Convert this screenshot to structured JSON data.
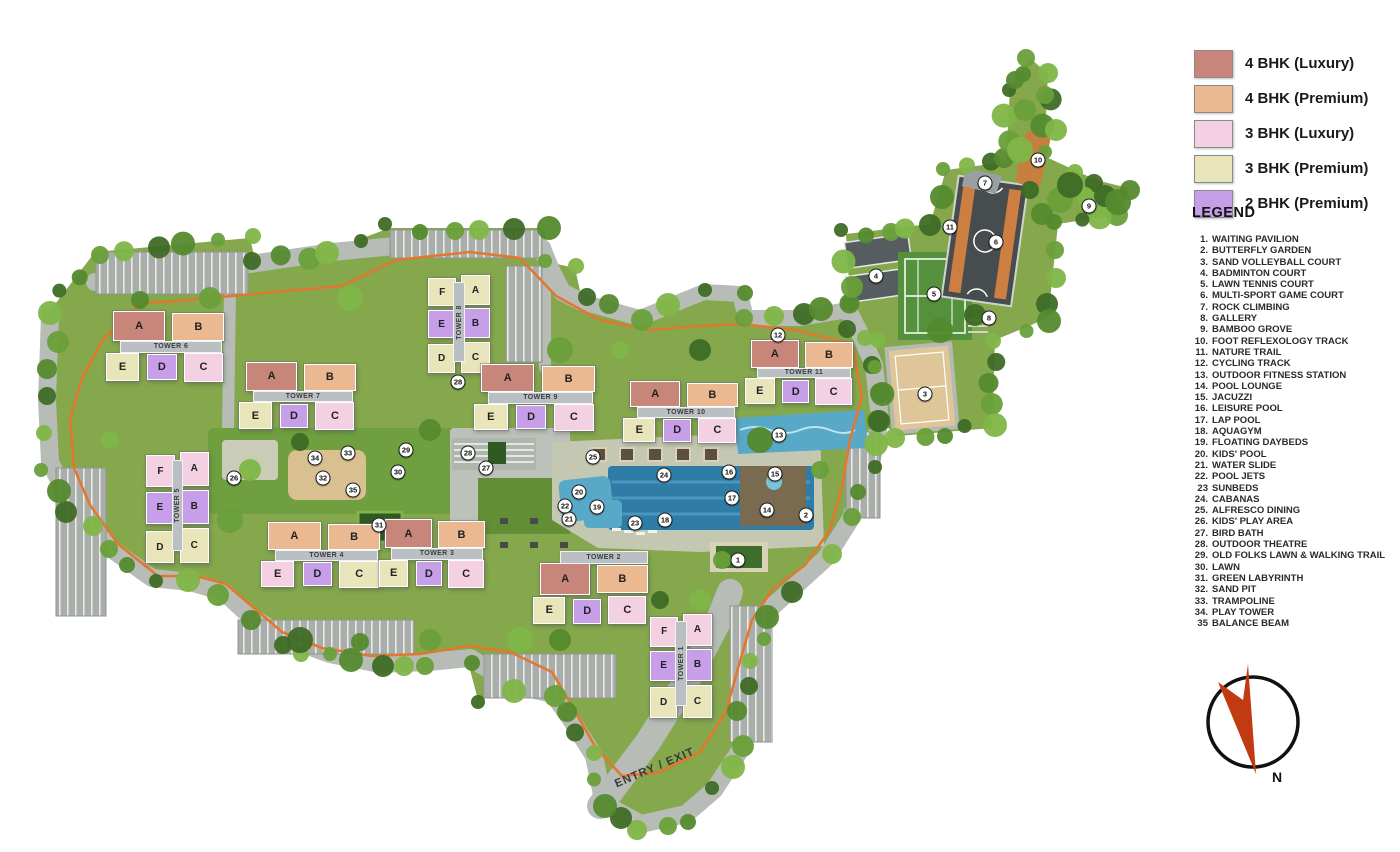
{
  "legend": {
    "title": "LEGEND",
    "swatches": [
      {
        "label": "4 BHK (Luxury)",
        "color": "#c8857a"
      },
      {
        "label": "4 BHK (Premium)",
        "color": "#eab891"
      },
      {
        "label": "3 BHK (Luxury)",
        "color": "#f3d1e3"
      },
      {
        "label": "3 BHK (Premium)",
        "color": "#e9e5bb"
      },
      {
        "label": "2 BHK (Premium)",
        "color": "#c69fe8"
      }
    ],
    "items": [
      {
        "n": "1.",
        "t": "WAITING PAVILION"
      },
      {
        "n": "2.",
        "t": "BUTTERFLY GARDEN"
      },
      {
        "n": "3.",
        "t": "SAND VOLLEYBALL COURT"
      },
      {
        "n": "4.",
        "t": "BADMINTON COURT"
      },
      {
        "n": "5.",
        "t": "LAWN TENNIS COURT"
      },
      {
        "n": "6.",
        "t": "MULTI-SPORT GAME COURT"
      },
      {
        "n": "7.",
        "t": "ROCK CLIMBING"
      },
      {
        "n": "8.",
        "t": "GALLERY"
      },
      {
        "n": "9.",
        "t": "BAMBOO GROVE"
      },
      {
        "n": "10.",
        "t": "FOOT REFLEXOLOGY TRACK"
      },
      {
        "n": "11.",
        "t": "NATURE TRAIL"
      },
      {
        "n": "12.",
        "t": "CYCLING TRACK"
      },
      {
        "n": "13.",
        "t": "OUTDOOR FITNESS STATION"
      },
      {
        "n": "14.",
        "t": "POOL LOUNGE"
      },
      {
        "n": "15.",
        "t": "JACUZZI"
      },
      {
        "n": "16.",
        "t": "LEISURE POOL"
      },
      {
        "n": "17.",
        "t": "LAP POOL"
      },
      {
        "n": "18.",
        "t": "AQUAGYM"
      },
      {
        "n": "19.",
        "t": "FLOATING DAYBEDS"
      },
      {
        "n": "20.",
        "t": "KIDS' POOL"
      },
      {
        "n": "21.",
        "t": "WATER SLIDE"
      },
      {
        "n": "22.",
        "t": "POOL JETS"
      },
      {
        "n": "23",
        "t": "SUNBEDS"
      },
      {
        "n": "24.",
        "t": "CABANAS"
      },
      {
        "n": "25.",
        "t": "ALFRESCO DINING"
      },
      {
        "n": "26.",
        "t": "KIDS' PLAY AREA"
      },
      {
        "n": "27.",
        "t": "BIRD BATH"
      },
      {
        "n": "28.",
        "t": "OUTDOOR THEATRE"
      },
      {
        "n": "29.",
        "t": "OLD FOLKS LAWN & WALKING TRAIL"
      },
      {
        "n": "30.",
        "t": "LAWN"
      },
      {
        "n": "31.",
        "t": "GREEN LABYRINTH"
      },
      {
        "n": "32.",
        "t": "SAND PIT"
      },
      {
        "n": "33.",
        "t": "TRAMPOLINE"
      },
      {
        "n": "34.",
        "t": "PLAY TOWER"
      },
      {
        "n": "35",
        "t": "BALANCE BEAM"
      }
    ]
  },
  "compass": {
    "n": "N"
  },
  "map": {
    "entry_label": "ENTRY / EXIT",
    "unit_types": {
      "4L": "#c8857a",
      "4P": "#eab891",
      "3L": "#f3d1e3",
      "3P": "#e9e5bb",
      "2P": "#c69fe8"
    },
    "towers": [
      {
        "name": "TOWER 6",
        "x": 113,
        "y": 311,
        "w": 114,
        "h": 70,
        "dir": "h",
        "units": [
          {
            "l": "A",
            "t": "4L"
          },
          {
            "l": "B",
            "t": "4P"
          },
          {
            "l": "E",
            "t": "3P"
          },
          {
            "l": "D",
            "t": "2P"
          },
          {
            "l": "C",
            "t": "3L"
          }
        ]
      },
      {
        "name": "TOWER 7",
        "x": 246,
        "y": 362,
        "w": 112,
        "h": 67,
        "dir": "h",
        "units": [
          {
            "l": "A",
            "t": "4L"
          },
          {
            "l": "B",
            "t": "4P"
          },
          {
            "l": "E",
            "t": "3P"
          },
          {
            "l": "D",
            "t": "2P"
          },
          {
            "l": "C",
            "t": "3L"
          }
        ]
      },
      {
        "name": "TOWER 8",
        "x": 428,
        "y": 275,
        "w": 60,
        "h": 100,
        "dir": "v",
        "units": [
          {
            "l": "F",
            "t": "3P"
          },
          {
            "l": "A",
            "t": "3P"
          },
          {
            "l": "E",
            "t": "2P"
          },
          {
            "l": "B",
            "t": "2P"
          },
          {
            "l": "D",
            "t": "3P"
          },
          {
            "l": "C",
            "t": "3P"
          }
        ]
      },
      {
        "name": "TOWER 9",
        "x": 481,
        "y": 364,
        "w": 117,
        "h": 66,
        "dir": "h",
        "units": [
          {
            "l": "A",
            "t": "4L"
          },
          {
            "l": "B",
            "t": "4P"
          },
          {
            "l": "E",
            "t": "3P"
          },
          {
            "l": "D",
            "t": "2P"
          },
          {
            "l": "C",
            "t": "3L"
          }
        ]
      },
      {
        "name": "TOWER 10",
        "x": 630,
        "y": 381,
        "w": 110,
        "h": 61,
        "dir": "h",
        "units": [
          {
            "l": "A",
            "t": "4L"
          },
          {
            "l": "B",
            "t": "4P"
          },
          {
            "l": "E",
            "t": "3P"
          },
          {
            "l": "D",
            "t": "2P"
          },
          {
            "l": "C",
            "t": "3L"
          }
        ]
      },
      {
        "name": "TOWER 11",
        "x": 751,
        "y": 340,
        "w": 104,
        "h": 64,
        "dir": "h",
        "units": [
          {
            "l": "A",
            "t": "4L"
          },
          {
            "l": "B",
            "t": "4P"
          },
          {
            "l": "E",
            "t": "3P"
          },
          {
            "l": "D",
            "t": "2P"
          },
          {
            "l": "C",
            "t": "3L"
          }
        ]
      },
      {
        "name": "TOWER 5",
        "x": 146,
        "y": 452,
        "w": 61,
        "h": 114,
        "dir": "v",
        "units": [
          {
            "l": "F",
            "t": "3L"
          },
          {
            "l": "A",
            "t": "3L"
          },
          {
            "l": "E",
            "t": "2P"
          },
          {
            "l": "B",
            "t": "2P"
          },
          {
            "l": "D",
            "t": "3P"
          },
          {
            "l": "C",
            "t": "3P"
          }
        ]
      },
      {
        "name": "TOWER 4",
        "x": 268,
        "y": 522,
        "w": 115,
        "h": 65,
        "dir": "h",
        "units": [
          {
            "l": "A",
            "t": "4P"
          },
          {
            "l": "B",
            "t": "4P"
          },
          {
            "l": "E",
            "t": "3L"
          },
          {
            "l": "D",
            "t": "2P"
          },
          {
            "l": "C",
            "t": "3P"
          }
        ]
      },
      {
        "name": "TOWER 3",
        "x": 385,
        "y": 519,
        "w": 102,
        "h": 68,
        "dir": "h",
        "units": [
          {
            "l": "A",
            "t": "4L"
          },
          {
            "l": "B",
            "t": "4P"
          },
          {
            "l": "E",
            "t": "3P"
          },
          {
            "l": "D",
            "t": "2P"
          },
          {
            "l": "C",
            "t": "3L"
          }
        ]
      },
      {
        "name": "TOWER 2",
        "x": 540,
        "y": 551,
        "w": 110,
        "h": 72,
        "dir": "h",
        "lt": 1,
        "units": [
          {
            "l": "A",
            "t": "4L"
          },
          {
            "l": "B",
            "t": "4P"
          },
          {
            "l": "E",
            "t": "3P"
          },
          {
            "l": "D",
            "t": "2P"
          },
          {
            "l": "C",
            "t": "3L"
          }
        ]
      },
      {
        "name": "TOWER 1",
        "x": 650,
        "y": 614,
        "w": 60,
        "h": 106,
        "dir": "v",
        "units": [
          {
            "l": "F",
            "t": "3L"
          },
          {
            "l": "A",
            "t": "3L"
          },
          {
            "l": "E",
            "t": "2P"
          },
          {
            "l": "B",
            "t": "2P"
          },
          {
            "l": "D",
            "t": "3P"
          },
          {
            "l": "C",
            "t": "3P"
          }
        ]
      }
    ],
    "markers": [
      {
        "n": 1,
        "x": 738,
        "y": 560
      },
      {
        "n": 2,
        "x": 806,
        "y": 515
      },
      {
        "n": 3,
        "x": 925,
        "y": 394
      },
      {
        "n": 4,
        "x": 876,
        "y": 276
      },
      {
        "n": 5,
        "x": 934,
        "y": 294
      },
      {
        "n": 6,
        "x": 996,
        "y": 242
      },
      {
        "n": 7,
        "x": 985,
        "y": 183
      },
      {
        "n": 8,
        "x": 989,
        "y": 318
      },
      {
        "n": 9,
        "x": 1089,
        "y": 206
      },
      {
        "n": 10,
        "x": 1038,
        "y": 160
      },
      {
        "n": 11,
        "x": 950,
        "y": 227
      },
      {
        "n": 12,
        "x": 778,
        "y": 335
      },
      {
        "n": 13,
        "x": 779,
        "y": 435
      },
      {
        "n": 14,
        "x": 767,
        "y": 510
      },
      {
        "n": 15,
        "x": 775,
        "y": 474
      },
      {
        "n": 16,
        "x": 729,
        "y": 472
      },
      {
        "n": 17,
        "x": 732,
        "y": 498
      },
      {
        "n": 18,
        "x": 665,
        "y": 520
      },
      {
        "n": 19,
        "x": 597,
        "y": 507
      },
      {
        "n": 20,
        "x": 579,
        "y": 492
      },
      {
        "n": 21,
        "x": 569,
        "y": 519
      },
      {
        "n": 22,
        "x": 565,
        "y": 506
      },
      {
        "n": 23,
        "x": 635,
        "y": 523
      },
      {
        "n": 24,
        "x": 664,
        "y": 475
      },
      {
        "n": 25,
        "x": 593,
        "y": 457
      },
      {
        "n": 26,
        "x": 234,
        "y": 478
      },
      {
        "n": 27,
        "x": 486,
        "y": 468
      },
      {
        "n": 28,
        "x": 468,
        "y": 453
      },
      {
        "n": 28,
        "x": 458,
        "y": 382
      },
      {
        "n": 29,
        "x": 406,
        "y": 450
      },
      {
        "n": 30,
        "x": 398,
        "y": 472
      },
      {
        "n": 31,
        "x": 379,
        "y": 525
      },
      {
        "n": 32,
        "x": 323,
        "y": 478
      },
      {
        "n": 33,
        "x": 348,
        "y": 453
      },
      {
        "n": 34,
        "x": 315,
        "y": 458
      },
      {
        "n": 35,
        "x": 353,
        "y": 490
      }
    ]
  }
}
